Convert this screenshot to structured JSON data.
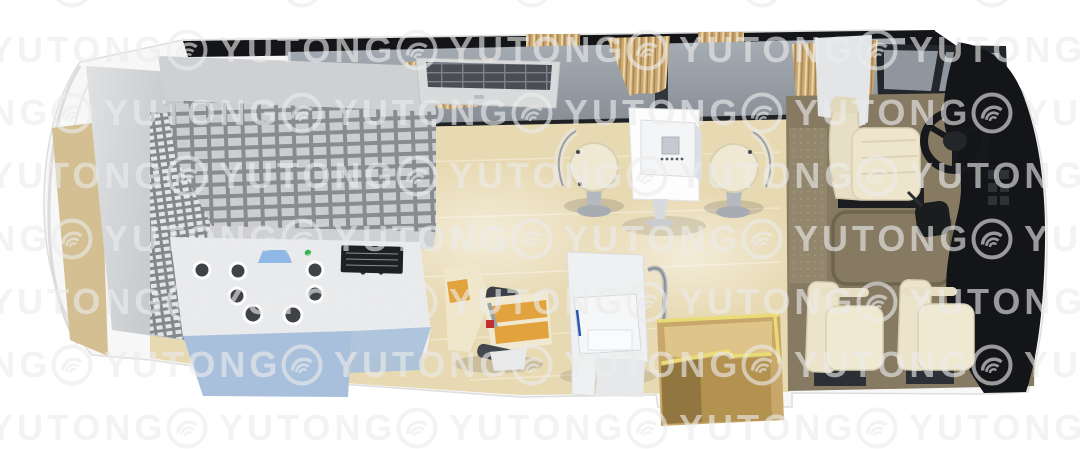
{
  "watermark": {
    "text": "YUTONG",
    "logo_icon": "yutong-arc-logo",
    "color": "#ececec"
  },
  "palette": {
    "bg": "#ffffff",
    "watermark": "#ececec",
    "wood": "#e7d9b2",
    "woodDark": "#d3bf92",
    "wall": "#939aa2",
    "windowGray": "#8f969e",
    "roof": "#141518",
    "cabinet": "#ced0d3",
    "counterBlue": "#a9c0dc",
    "counterTop": "#e9eaec",
    "curtain": "#cba873",
    "seatCream": "#ece4ca",
    "accentOrange": "#e2a33e",
    "driverFloor": "#867a63",
    "dash": "#141518",
    "stepsWood": "#c8a76b",
    "stepsGold": "#e9dc74",
    "ledGreen": "#36b24a",
    "sinkBlue": "#8fb9e4",
    "chrome": "#b4b9bf"
  },
  "scene": {
    "description": "top-down 3D render of bus interior floor plan",
    "objects": [
      "rear-storage-cabinet",
      "pigeonhole-shelf-unit",
      "dispensing-counter",
      "counter-sink",
      "counter-control-panel",
      "status-led",
      "overhead-ac-unit",
      "window-curtains",
      "work-table",
      "tabletop-device",
      "round-stool-left",
      "round-stool-right",
      "patient-chair",
      "consultation-desk",
      "desk-device",
      "grab-rail",
      "entry-steps",
      "floor-mat",
      "driver-seat",
      "steering-wheel",
      "gear-console",
      "dashboard",
      "passenger-seat-front",
      "passenger-seat-rear",
      "windshield"
    ]
  }
}
